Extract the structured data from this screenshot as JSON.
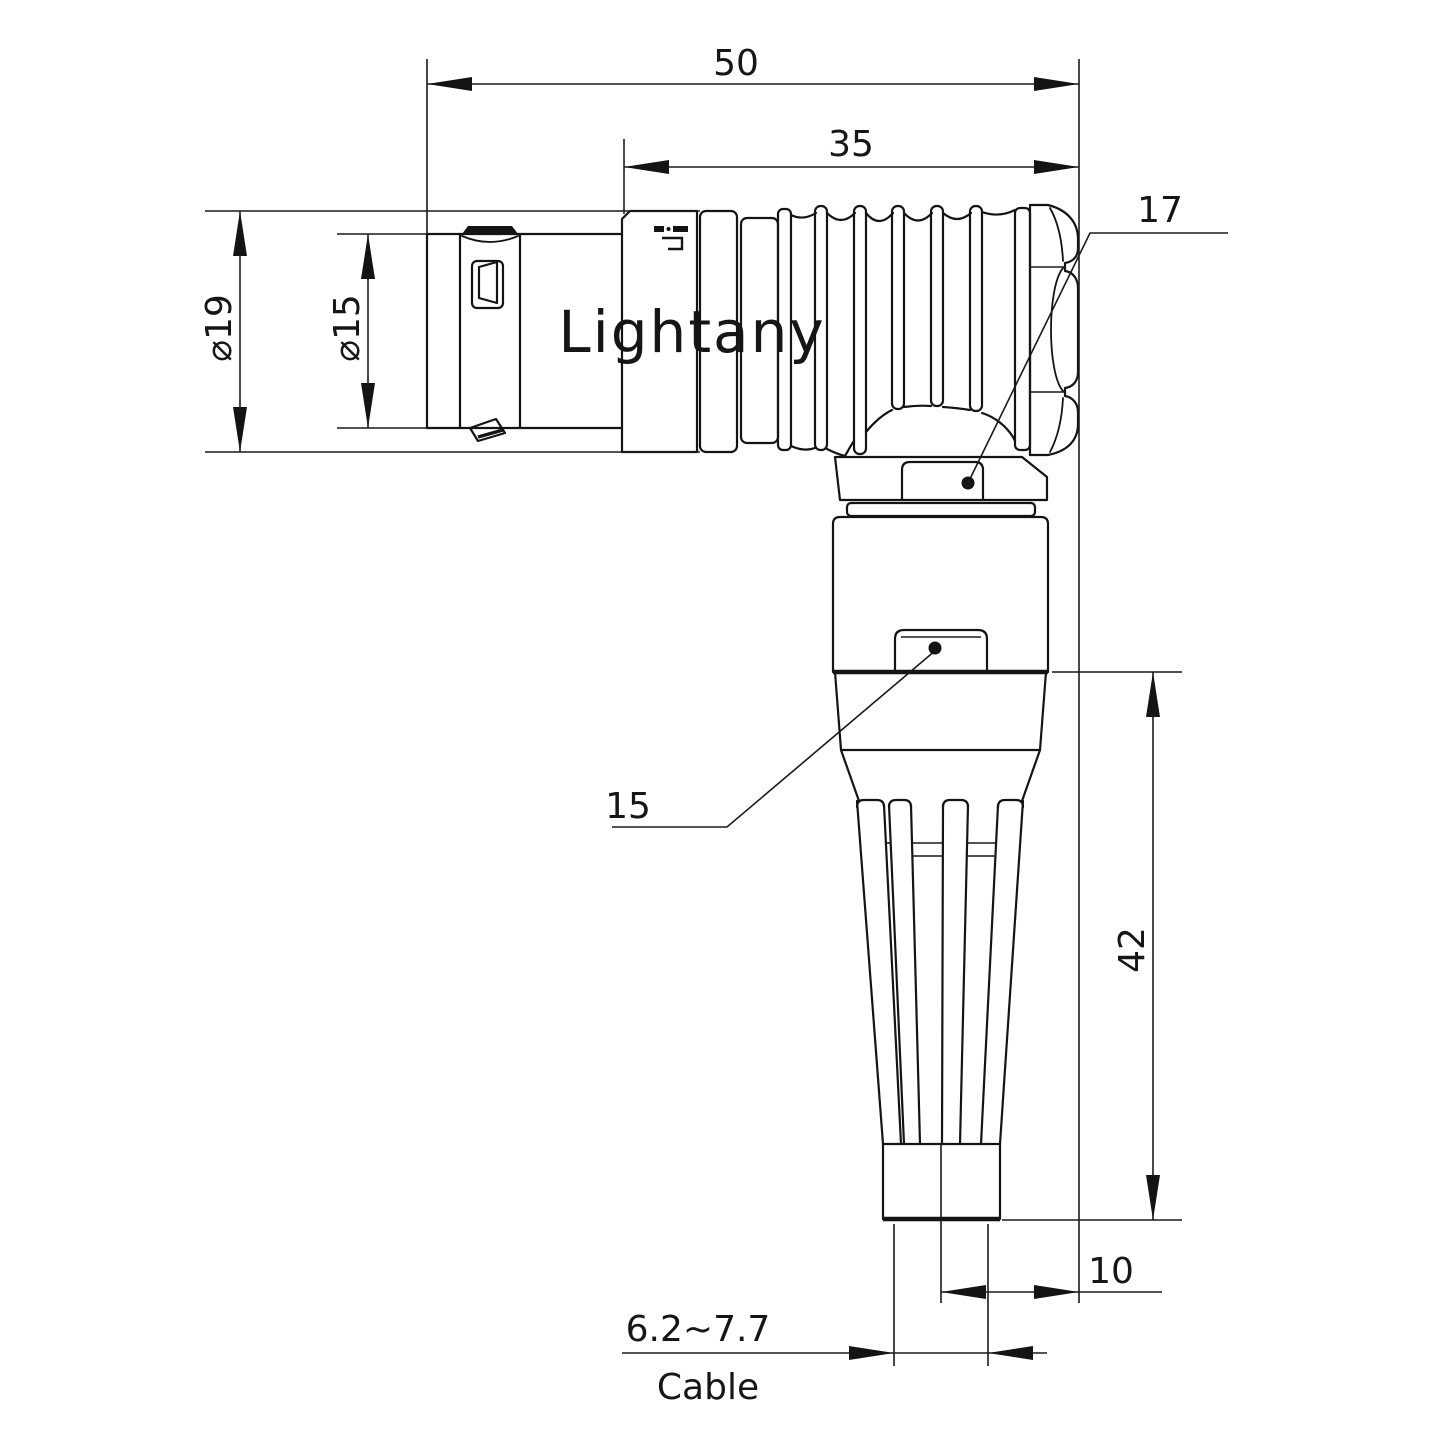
{
  "watermark": {
    "text": "Lightany",
    "color": "#f6d6d6"
  },
  "drawing": {
    "type": "right-angle connector, 2-view engineering dimension drawing",
    "line_color": "#141414",
    "background": "#ffffff"
  },
  "labels": {
    "dim_overall_length": "50",
    "dim_body_length": "35",
    "dim_outer_diameter": "⌀19",
    "dim_front_diameter": "⌀15",
    "ref_nut": "17",
    "ref_body": "15",
    "dim_vertical_length": "42",
    "dim_axis_offset": "10",
    "dim_cable_range": "6.2~7.7",
    "cable_caption": "Cable"
  }
}
